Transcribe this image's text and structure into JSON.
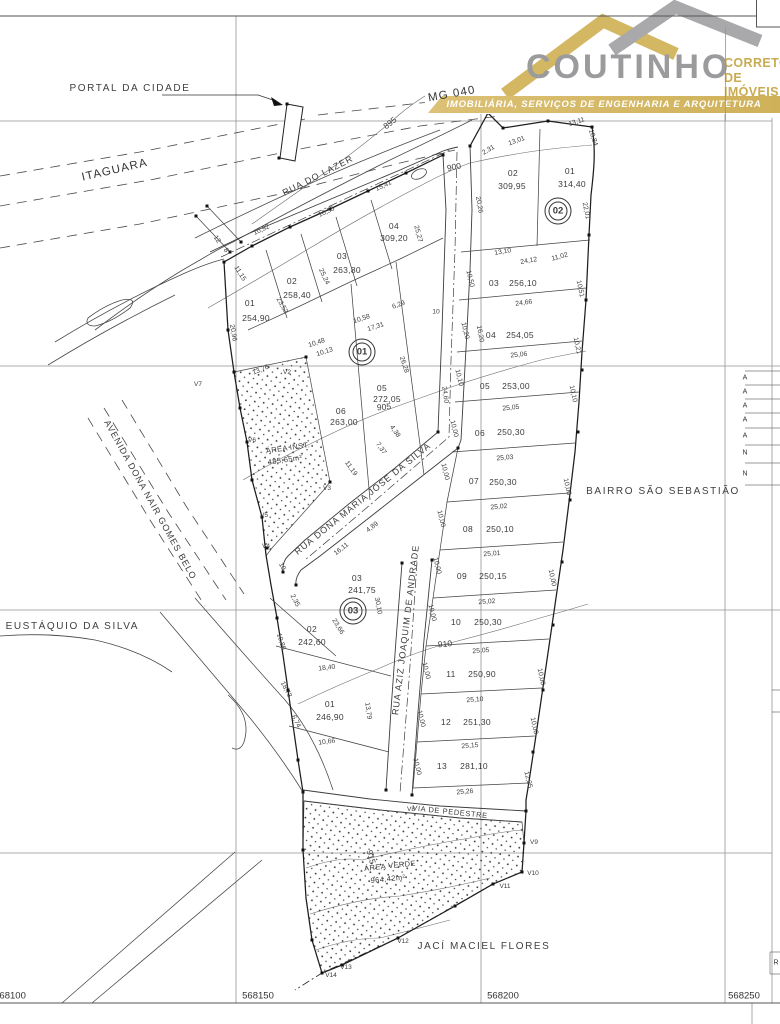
{
  "logo": {
    "brand": "COUTINHO",
    "tagline_line1": "CORRETOR",
    "tagline_line2": "DE IMÓVEIS",
    "banner": "IMOBILIÁRIA, SERVIÇOS DE ENGENHARIA E ARQUITETURA",
    "colors": {
      "gold": "#CBAD5C",
      "gray": "#9B9B9D",
      "banner_gold": "#D3B766"
    }
  },
  "map": {
    "type": "cadastral-subdivision-plan",
    "utm_coordinates": [
      "568100",
      "568150",
      "568200",
      "568250"
    ],
    "contour_elevations": [
      "895",
      "900",
      "905",
      "910",
      "915"
    ],
    "labels": [
      {
        "t": "PORTAL DA CIDADE",
        "x": 130,
        "y": 89,
        "k": "place",
        "n": "portal-da-cidade"
      },
      {
        "t": "MG 040",
        "x": 452,
        "y": 95,
        "r": -10,
        "k": "road",
        "n": "road-mg040"
      },
      {
        "t": "ITAGUARA",
        "x": 115,
        "y": 171,
        "r": -13,
        "k": "road",
        "n": "road-itaguara"
      },
      {
        "t": "RUA DO LAZER",
        "x": 318,
        "y": 176,
        "r": -27,
        "k": "street",
        "n": "rua-do-lazer"
      },
      {
        "t": "AVENIDA DONA NAIR GOMES BELO",
        "x": 150,
        "y": 500,
        "r": 61,
        "k": "street",
        "n": "avenida-dona-nair-gomes-belo"
      },
      {
        "t": "E EUSTÁQUIO DA SILVA",
        "x": 66,
        "y": 627,
        "k": "place",
        "n": "rua-eustaquio-da-silva"
      },
      {
        "t": "RUA  DONA MARIA JOSE DA SILVA",
        "x": 363,
        "y": 499,
        "r": -39,
        "k": "street",
        "n": "rua-dona-maria-jose-da-silva"
      },
      {
        "t": "RUA AZIZ JOAQUIM DE ANDRADE",
        "x": 406,
        "y": 630,
        "r": -83,
        "k": "street",
        "n": "rua-aziz-joaquim-de-andrade"
      },
      {
        "t": "VIA DE PEDESTRE",
        "x": 450,
        "y": 812,
        "r": 6,
        "k": "pstreet",
        "n": "via-de-pedestre"
      },
      {
        "t": "BAIRRO SÃO SEBASTIÃO",
        "x": 663,
        "y": 492,
        "k": "place",
        "n": "bairro-sao-sebastiao"
      },
      {
        "t": "JACÍ MACIEL FLORES",
        "x": 484,
        "y": 947,
        "k": "place",
        "n": "jaci-maciel-flores"
      },
      {
        "t": "ÁREA INST.",
        "x": 288,
        "y": 448,
        "r": -8,
        "k": "area"
      },
      {
        "t": "485,65m²",
        "x": 285,
        "y": 460,
        "r": -8,
        "k": "area"
      },
      {
        "t": "ÁREA VERDE",
        "x": 390,
        "y": 866,
        "r": -6,
        "k": "area"
      },
      {
        "t": "964,42m²",
        "x": 388,
        "y": 879,
        "r": -6,
        "k": "area"
      },
      {
        "t": "895",
        "x": 390,
        "y": 123,
        "r": -38,
        "k": "contour"
      },
      {
        "t": "900",
        "x": 454,
        "y": 167,
        "r": -12,
        "k": "contour"
      },
      {
        "t": "905",
        "x": 384,
        "y": 407,
        "r": -5,
        "k": "contour"
      },
      {
        "t": "910",
        "x": 445,
        "y": 644,
        "r": -5,
        "k": "contour"
      },
      {
        "t": "915",
        "x": 371,
        "y": 857,
        "r": 75,
        "k": "contour"
      },
      {
        "t": "01",
        "x": 250,
        "y": 303,
        "k": "lotn"
      },
      {
        "t": "254,90",
        "x": 256,
        "y": 318,
        "k": "lota"
      },
      {
        "t": "02",
        "x": 292,
        "y": 281,
        "k": "lotn"
      },
      {
        "t": "258,40",
        "x": 297,
        "y": 295,
        "k": "lota"
      },
      {
        "t": "03",
        "x": 342,
        "y": 256,
        "k": "lotn"
      },
      {
        "t": "263,80",
        "x": 347,
        "y": 270,
        "k": "lota"
      },
      {
        "t": "04",
        "x": 394,
        "y": 226,
        "k": "lotn"
      },
      {
        "t": "309,20",
        "x": 394,
        "y": 238,
        "k": "lota"
      },
      {
        "t": "05",
        "x": 382,
        "y": 388,
        "k": "lotn"
      },
      {
        "t": "272,05",
        "x": 387,
        "y": 399,
        "k": "lota"
      },
      {
        "t": "06",
        "x": 341,
        "y": 411,
        "k": "lotn"
      },
      {
        "t": "263,00",
        "x": 344,
        "y": 422,
        "k": "lota"
      },
      {
        "t": "02",
        "x": 513,
        "y": 173,
        "k": "lotn"
      },
      {
        "t": "309,95",
        "x": 512,
        "y": 186,
        "k": "lota"
      },
      {
        "t": "01",
        "x": 570,
        "y": 171,
        "k": "lotn"
      },
      {
        "t": "314,40",
        "x": 572,
        "y": 184,
        "k": "lota"
      },
      {
        "t": "03",
        "x": 494,
        "y": 283,
        "k": "lotn"
      },
      {
        "t": "256,10",
        "x": 523,
        "y": 283,
        "k": "lota"
      },
      {
        "t": "04",
        "x": 491,
        "y": 335,
        "k": "lotn"
      },
      {
        "t": "254,05",
        "x": 520,
        "y": 335,
        "k": "lota"
      },
      {
        "t": "05",
        "x": 485,
        "y": 386,
        "k": "lotn"
      },
      {
        "t": "253,00",
        "x": 516,
        "y": 386,
        "k": "lota"
      },
      {
        "t": "06",
        "x": 480,
        "y": 433,
        "k": "lotn"
      },
      {
        "t": "250,30",
        "x": 511,
        "y": 432,
        "k": "lota"
      },
      {
        "t": "07",
        "x": 474,
        "y": 481,
        "k": "lotn"
      },
      {
        "t": "250,30",
        "x": 503,
        "y": 482,
        "k": "lota"
      },
      {
        "t": "08",
        "x": 468,
        "y": 529,
        "k": "lotn"
      },
      {
        "t": "250,10",
        "x": 500,
        "y": 529,
        "k": "lota"
      },
      {
        "t": "09",
        "x": 462,
        "y": 576,
        "k": "lotn"
      },
      {
        "t": "250,15",
        "x": 493,
        "y": 576,
        "k": "lota"
      },
      {
        "t": "10",
        "x": 456,
        "y": 622,
        "k": "lotn"
      },
      {
        "t": "250,30",
        "x": 488,
        "y": 622,
        "k": "lota"
      },
      {
        "t": "11",
        "x": 451,
        "y": 674,
        "k": "lotn"
      },
      {
        "t": "250,90",
        "x": 482,
        "y": 674,
        "k": "lota"
      },
      {
        "t": "12",
        "x": 446,
        "y": 722,
        "k": "lotn"
      },
      {
        "t": "251,30",
        "x": 477,
        "y": 722,
        "k": "lota"
      },
      {
        "t": "13",
        "x": 442,
        "y": 766,
        "k": "lotn"
      },
      {
        "t": "281,10",
        "x": 474,
        "y": 766,
        "k": "lota"
      },
      {
        "t": "03",
        "x": 357,
        "y": 578,
        "k": "lotn"
      },
      {
        "t": "241,75",
        "x": 362,
        "y": 590,
        "k": "lota"
      },
      {
        "t": "02",
        "x": 312,
        "y": 629,
        "k": "lotn"
      },
      {
        "t": "242,60",
        "x": 312,
        "y": 642,
        "k": "lota"
      },
      {
        "t": "01",
        "x": 330,
        "y": 704,
        "k": "lotn"
      },
      {
        "t": "246,90",
        "x": 330,
        "y": 717,
        "k": "lota"
      },
      {
        "t": "01",
        "x": 362,
        "y": 352,
        "k": "quadra",
        "n": "quadra-01-badge"
      },
      {
        "t": "02",
        "x": 558,
        "y": 211,
        "k": "quadra",
        "n": "quadra-02-badge"
      },
      {
        "t": "03",
        "x": 353,
        "y": 611,
        "k": "quadra",
        "n": "quadra-03-badge"
      },
      {
        "t": "15,41",
        "x": 384,
        "y": 187,
        "r": -25,
        "k": "dim"
      },
      {
        "t": "10,55",
        "x": 327,
        "y": 213,
        "r": -25,
        "k": "dim"
      },
      {
        "t": "10,92",
        "x": 262,
        "y": 231,
        "r": -25,
        "k": "dim"
      },
      {
        "t": "12",
        "x": 216,
        "y": 240,
        "r": 55,
        "k": "dim"
      },
      {
        "t": "8",
        "x": 225,
        "y": 251,
        "r": 55,
        "k": "dim"
      },
      {
        "t": "11,15",
        "x": 239,
        "y": 274,
        "r": 58,
        "k": "dim"
      },
      {
        "t": "23,52",
        "x": 281,
        "y": 306,
        "r": 60,
        "k": "dim"
      },
      {
        "t": "25,24",
        "x": 323,
        "y": 277,
        "r": 65,
        "k": "dim"
      },
      {
        "t": "25,27",
        "x": 417,
        "y": 234,
        "r": 75,
        "k": "dim"
      },
      {
        "t": "20,26",
        "x": 478,
        "y": 205,
        "r": 80,
        "k": "dim"
      },
      {
        "t": "20,96",
        "x": 232,
        "y": 333,
        "r": 80,
        "k": "dim"
      },
      {
        "t": "6,29",
        "x": 399,
        "y": 306,
        "r": -20,
        "k": "dim"
      },
      {
        "t": "10,58",
        "x": 362,
        "y": 320,
        "r": -18,
        "k": "dim"
      },
      {
        "t": "17,31",
        "x": 376,
        "y": 328,
        "r": -18,
        "k": "dim"
      },
      {
        "t": "10",
        "x": 436,
        "y": 313,
        "k": "dim"
      },
      {
        "t": "10,48",
        "x": 317,
        "y": 344,
        "r": -18,
        "k": "dim"
      },
      {
        "t": "10,13",
        "x": 325,
        "y": 353,
        "r": -18,
        "k": "dim"
      },
      {
        "t": "13,76",
        "x": 261,
        "y": 371,
        "r": -22,
        "k": "dim"
      },
      {
        "t": "26,28",
        "x": 403,
        "y": 365,
        "r": 72,
        "k": "dim"
      },
      {
        "t": "24,60",
        "x": 444,
        "y": 395,
        "r": 82,
        "k": "dim"
      },
      {
        "t": "16,20",
        "x": 479,
        "y": 334,
        "r": 80,
        "k": "dim"
      },
      {
        "t": "11,19",
        "x": 350,
        "y": 469,
        "r": 55,
        "k": "dim"
      },
      {
        "t": "7,37",
        "x": 380,
        "y": 449,
        "r": 55,
        "k": "dim"
      },
      {
        "t": "4,38",
        "x": 394,
        "y": 432,
        "r": 55,
        "k": "dim"
      },
      {
        "t": "4,89",
        "x": 373,
        "y": 528,
        "r": -38,
        "k": "dim"
      },
      {
        "t": "16,11",
        "x": 342,
        "y": 550,
        "r": -38,
        "k": "dim"
      },
      {
        "t": "10",
        "x": 281,
        "y": 567,
        "r": 62,
        "k": "dim"
      },
      {
        "t": "2,35",
        "x": 294,
        "y": 601,
        "r": 62,
        "k": "dim"
      },
      {
        "t": "30,10",
        "x": 377,
        "y": 606,
        "r": 80,
        "k": "dim"
      },
      {
        "t": "23,66",
        "x": 337,
        "y": 627,
        "r": 58,
        "k": "dim"
      },
      {
        "t": "10,86",
        "x": 280,
        "y": 642,
        "r": 72,
        "k": "dim"
      },
      {
        "t": "18,40",
        "x": 327,
        "y": 669,
        "r": -7,
        "k": "dim"
      },
      {
        "t": "18,73",
        "x": 285,
        "y": 690,
        "r": 62,
        "k": "dim"
      },
      {
        "t": "13,79",
        "x": 367,
        "y": 711,
        "r": 82,
        "k": "dim"
      },
      {
        "t": "6,74",
        "x": 295,
        "y": 722,
        "r": 62,
        "k": "dim"
      },
      {
        "t": "10,66",
        "x": 327,
        "y": 743,
        "r": -8,
        "k": "dim"
      },
      {
        "t": "13,11",
        "x": 577,
        "y": 123,
        "r": -18,
        "k": "dim"
      },
      {
        "t": "10,84",
        "x": 592,
        "y": 138,
        "r": 72,
        "k": "dim"
      },
      {
        "t": "13,01",
        "x": 517,
        "y": 142,
        "r": -20,
        "k": "dim"
      },
      {
        "t": "2,31",
        "x": 489,
        "y": 151,
        "r": -30,
        "k": "dim"
      },
      {
        "t": "22,01",
        "x": 585,
        "y": 211,
        "r": 78,
        "k": "dim"
      },
      {
        "t": "13,10",
        "x": 503,
        "y": 253,
        "r": -10,
        "k": "dim"
      },
      {
        "t": "24,12",
        "x": 529,
        "y": 262,
        "r": -10,
        "k": "dim"
      },
      {
        "t": "11,02",
        "x": 560,
        "y": 258,
        "r": -15,
        "k": "dim"
      },
      {
        "t": "10,51",
        "x": 579,
        "y": 289,
        "r": 78,
        "k": "dim"
      },
      {
        "t": "24,66",
        "x": 524,
        "y": 304,
        "r": -8,
        "k": "dim"
      },
      {
        "t": "10,21",
        "x": 576,
        "y": 346,
        "r": 78,
        "k": "dim"
      },
      {
        "t": "25,06",
        "x": 519,
        "y": 356,
        "r": -6,
        "k": "dim"
      },
      {
        "t": "10,10",
        "x": 572,
        "y": 394,
        "r": 78,
        "k": "dim"
      },
      {
        "t": "25,05",
        "x": 511,
        "y": 409,
        "r": -6,
        "k": "dim"
      },
      {
        "t": "10,50",
        "x": 469,
        "y": 279,
        "r": 76,
        "k": "dim"
      },
      {
        "t": "10,20",
        "x": 464,
        "y": 331,
        "r": 76,
        "k": "dim"
      },
      {
        "t": "10,10",
        "x": 458,
        "y": 378,
        "r": 76,
        "k": "dim"
      },
      {
        "t": "10,00",
        "x": 453,
        "y": 429,
        "r": 76,
        "k": "dim"
      },
      {
        "t": "25,03",
        "x": 505,
        "y": 459,
        "r": -5,
        "k": "dim"
      },
      {
        "t": "10,00",
        "x": 566,
        "y": 487,
        "r": 78,
        "k": "dim"
      },
      {
        "t": "25,02",
        "x": 499,
        "y": 508,
        "r": -5,
        "k": "dim"
      },
      {
        "t": "10,00",
        "x": 444,
        "y": 472,
        "r": 76,
        "k": "dim"
      },
      {
        "t": "10,00",
        "x": 440,
        "y": 519,
        "r": 76,
        "k": "dim"
      },
      {
        "t": "25,01",
        "x": 492,
        "y": 555,
        "r": -4,
        "k": "dim"
      },
      {
        "t": "10,00",
        "x": 551,
        "y": 578,
        "r": 78,
        "k": "dim"
      },
      {
        "t": "10,00",
        "x": 436,
        "y": 566,
        "r": 76,
        "k": "dim"
      },
      {
        "t": "25,02",
        "x": 487,
        "y": 603,
        "r": -4,
        "k": "dim"
      },
      {
        "t": "10,00",
        "x": 431,
        "y": 613,
        "r": 76,
        "k": "dim"
      },
      {
        "t": "25,05",
        "x": 481,
        "y": 652,
        "r": -4,
        "k": "dim"
      },
      {
        "t": "10,00",
        "x": 540,
        "y": 677,
        "r": 78,
        "k": "dim"
      },
      {
        "t": "10,00",
        "x": 425,
        "y": 671,
        "r": 76,
        "k": "dim"
      },
      {
        "t": "25,10",
        "x": 475,
        "y": 701,
        "r": -4,
        "k": "dim"
      },
      {
        "t": "10,00",
        "x": 533,
        "y": 726,
        "r": 78,
        "k": "dim"
      },
      {
        "t": "10,00",
        "x": 420,
        "y": 719,
        "r": 76,
        "k": "dim"
      },
      {
        "t": "25,15",
        "x": 470,
        "y": 747,
        "r": -4,
        "k": "dim"
      },
      {
        "t": "10,00",
        "x": 416,
        "y": 767,
        "r": 76,
        "k": "dim"
      },
      {
        "t": "12,35",
        "x": 527,
        "y": 780,
        "r": 76,
        "k": "dim"
      },
      {
        "t": "25,26",
        "x": 465,
        "y": 793,
        "r": -5,
        "k": "dim"
      },
      {
        "t": "V2",
        "x": 287,
        "y": 373,
        "k": "vx"
      },
      {
        "t": "V3",
        "x": 327,
        "y": 489,
        "k": "vx"
      },
      {
        "t": "V4",
        "x": 266,
        "y": 547,
        "k": "vx"
      },
      {
        "t": "V5",
        "x": 264,
        "y": 516,
        "k": "vx"
      },
      {
        "t": "V6",
        "x": 252,
        "y": 441,
        "k": "vx"
      },
      {
        "t": "V7",
        "x": 198,
        "y": 385,
        "k": "vx"
      },
      {
        "t": "V8",
        "x": 411,
        "y": 810,
        "k": "vx"
      },
      {
        "t": "V9",
        "x": 534,
        "y": 843,
        "k": "vx"
      },
      {
        "t": "V10",
        "x": 533,
        "y": 874,
        "k": "vx"
      },
      {
        "t": "V11",
        "x": 505,
        "y": 887,
        "k": "vx"
      },
      {
        "t": "V12",
        "x": 403,
        "y": 942,
        "k": "vx"
      },
      {
        "t": "V13",
        "x": 346,
        "y": 968,
        "k": "vx"
      },
      {
        "t": "V14",
        "x": 331,
        "y": 976,
        "k": "vx"
      },
      {
        "t": "568100",
        "x": 10,
        "y": 996,
        "k": "coord"
      },
      {
        "t": "568150",
        "x": 258,
        "y": 996,
        "k": "coord"
      },
      {
        "t": "568200",
        "x": 503,
        "y": 996,
        "k": "coord"
      },
      {
        "t": "568250",
        "x": 744,
        "y": 996,
        "k": "coord"
      },
      {
        "t": "A",
        "x": 745,
        "y": 378,
        "k": "tbl"
      },
      {
        "t": "A",
        "x": 745,
        "y": 392,
        "k": "tbl"
      },
      {
        "t": "A",
        "x": 745,
        "y": 406,
        "k": "tbl"
      },
      {
        "t": "A",
        "x": 745,
        "y": 420,
        "k": "tbl"
      },
      {
        "t": "A",
        "x": 745,
        "y": 436,
        "k": "tbl"
      },
      {
        "t": "N",
        "x": 745,
        "y": 453,
        "k": "tbl"
      },
      {
        "t": "N",
        "x": 745,
        "y": 474,
        "k": "tbl"
      },
      {
        "t": "R",
        "x": 776,
        "y": 963,
        "k": "tbl"
      }
    ]
  }
}
